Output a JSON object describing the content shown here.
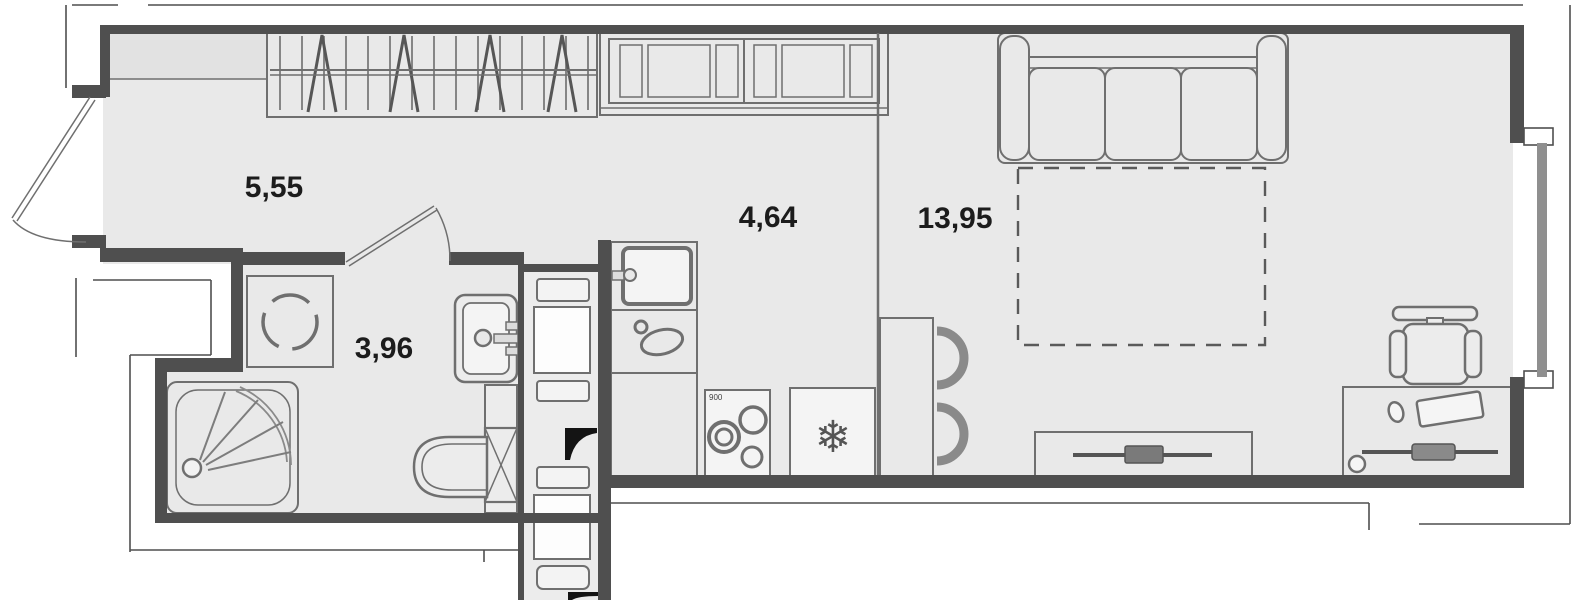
{
  "rooms": {
    "hallway": {
      "area": "5,55"
    },
    "kitchen": {
      "area": "4,64"
    },
    "living": {
      "area": "13,95"
    },
    "bathroom": {
      "area": "3,96"
    }
  },
  "annotations": {
    "stove_size": "900"
  },
  "icons": {
    "fridge_icon": "❄",
    "fixtures": [
      "entrance-door",
      "bathroom-door",
      "wardrobe-hangers-icon",
      "shelf",
      "kitchen-cabinets",
      "kitchen-sink-icon",
      "decor-symbol-icon",
      "stove-burners-icon",
      "fridge-snowflake-icon",
      "dining-table",
      "chair-icon",
      "sofa",
      "sofa-bed-dashed-outline",
      "tv-stand-icon",
      "desk",
      "office-chair-icon",
      "washing-machine-icon",
      "shower-icon",
      "washbasin-icon",
      "toilet-icon",
      "ventilation-duct",
      "vent-marker-icon",
      "window"
    ]
  },
  "colors": {
    "background": "#ffffff",
    "floor": "#e9e9e9",
    "wall": "#4f4f4f",
    "outline": "#6f6f6f",
    "vent_marker": "#141414"
  }
}
